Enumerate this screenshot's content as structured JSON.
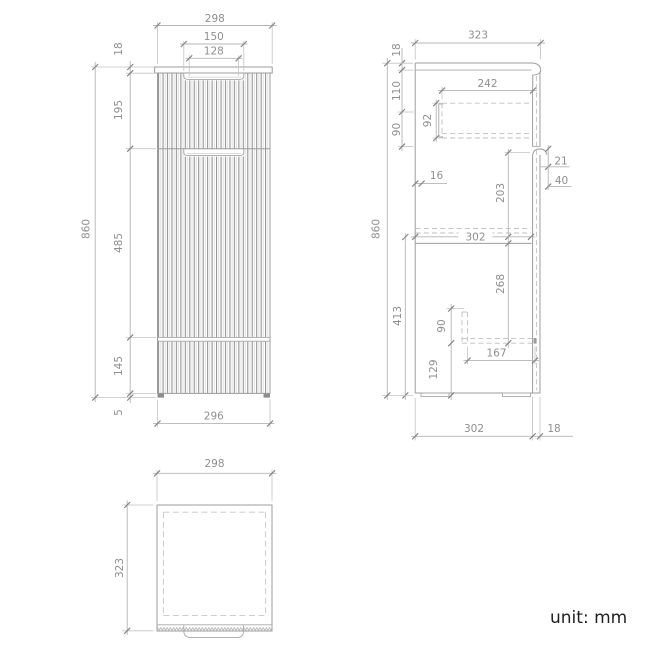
{
  "unit_note": "unit: mm",
  "front": {
    "overall_width": "298",
    "handle_recess_width": "150",
    "handle_inner_width": "128",
    "countertop_thickness": "18",
    "drawer_front_height": "195",
    "door_height": "485",
    "base_panel_height": "145",
    "foot_height": "5",
    "overall_height": "860",
    "body_width": "296"
  },
  "side": {
    "overall_depth": "323",
    "countertop_thickness": "18",
    "drawer_top_offset": "110",
    "drawer_zone_height": "90",
    "drawer_box_height": "92",
    "drawer_box_depth": "242",
    "back_clearance": "16",
    "handle_lip": "21",
    "handle_zone": "40",
    "upper_section_height": "203",
    "internal_depth": "302",
    "shelf_clearance": "268",
    "lower_section_height": "413",
    "foot_bracket_height": "90",
    "foot_bracket_depth": "167",
    "plinth_height": "129",
    "overall_height": "860",
    "body_depth": "302",
    "front_panel_thickness": "18"
  },
  "top": {
    "overall_width": "298",
    "overall_depth": "323"
  }
}
